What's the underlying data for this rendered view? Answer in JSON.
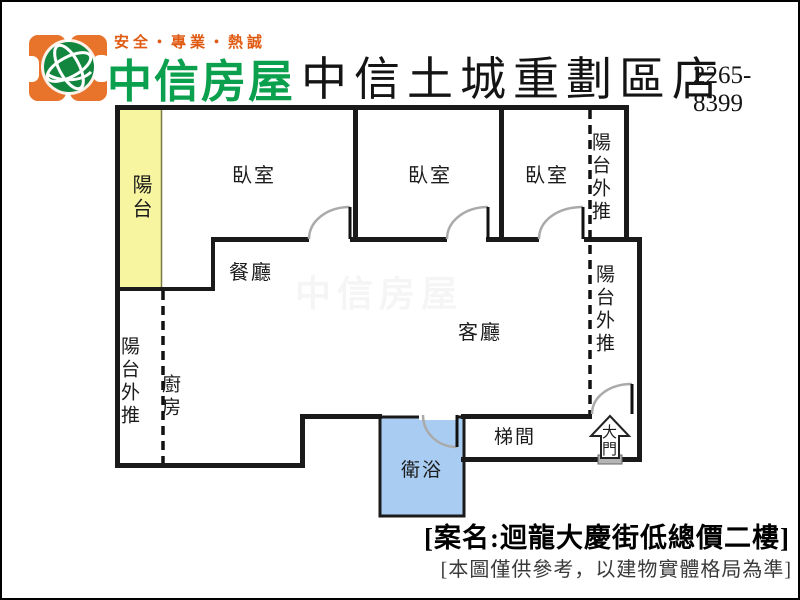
{
  "header": {
    "slogan": "安全・專業・熱誠",
    "brand": "中信房屋",
    "store_name": "中信土城重劃區店",
    "phone": "2265-8399",
    "colors": {
      "logo_orange": "#E8742B",
      "brand_green": "#0AA04E",
      "slogan_orange": "#E05A12"
    }
  },
  "floorplan": {
    "labels": {
      "balcony": "陽台",
      "bedroom_left": "臥室",
      "bedroom_middle": "臥室",
      "bedroom_right": "臥室",
      "dining_room": "餐廳",
      "living_room": "客廳",
      "kitchen": "廚房",
      "bathroom": "衛浴",
      "stair_hall": "梯間",
      "main_door": "大門",
      "balcony_extension_left": "陽台外推",
      "balcony_extension_top_right": "陽台外推",
      "balcony_extension_right": "陽台外推"
    },
    "colors": {
      "balcony_fill": "#F8F5A0",
      "bathroom_fill": "#A9CDF2",
      "wall": "#1A1A1A",
      "door_arc": "#AAAAAA",
      "threshold_gray": "#B5B5B5"
    },
    "watermark": "中信房屋"
  },
  "footer": {
    "case_name": "[案名:迴龍大慶街低總價二樓]",
    "disclaimer": "[本圖僅供參考，以建物實體格局為準]"
  }
}
